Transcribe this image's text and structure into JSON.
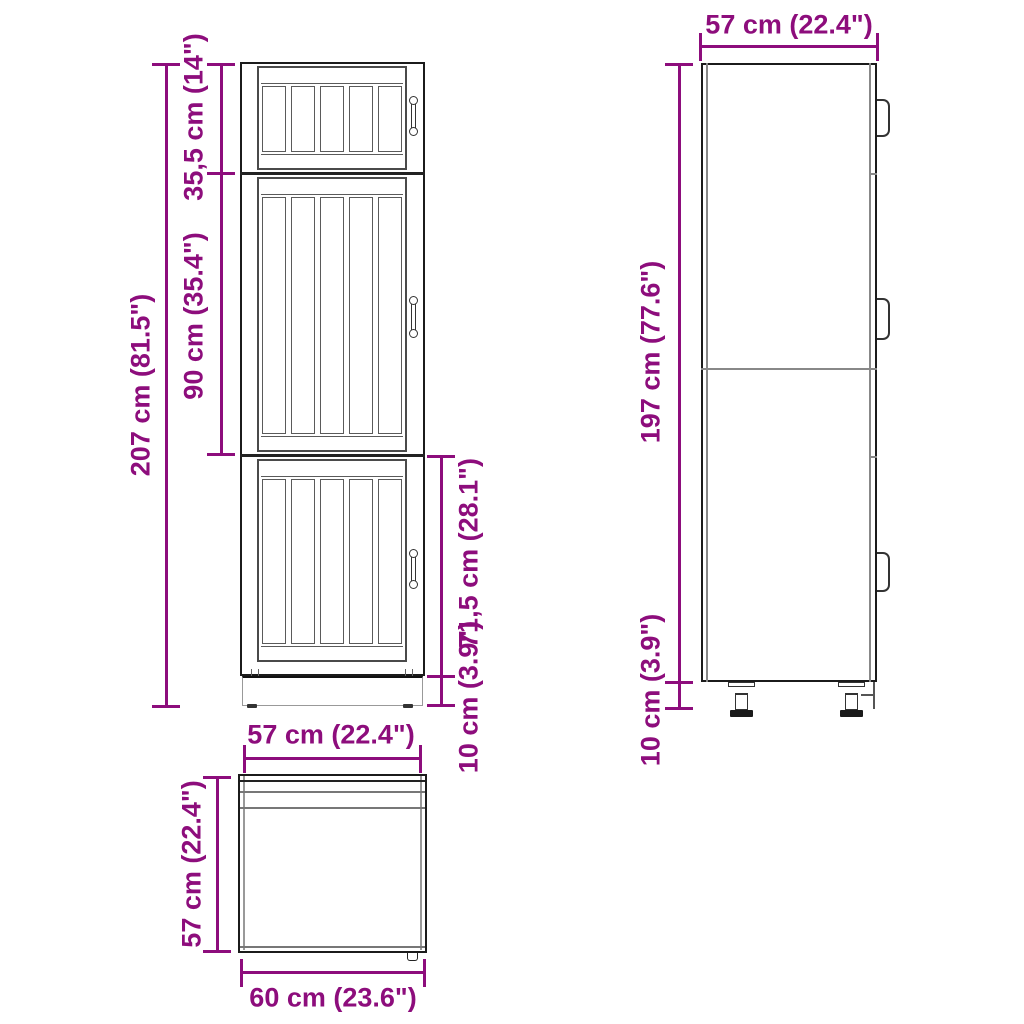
{
  "diagram_title": "tall kitchen cabinet dimension drawing",
  "colors": {
    "accent": "#8d0d7c",
    "line_dark": "#1b1b1b",
    "line_mid": "#555555",
    "line_light": "#999999",
    "background": "#ffffff"
  },
  "views": {
    "front": {
      "dims": {
        "total_height": "207 cm (81.5\")",
        "top_section": "35,5 cm (14\")",
        "middle_section": "90 cm (35.4\")",
        "bottom_section": "71,5 cm (28.1\")",
        "plinth": "10 cm (3.9\")"
      }
    },
    "side": {
      "dims": {
        "depth": "57 cm (22.4\")",
        "body_height": "197 cm (77.6\")",
        "plinth": "10 cm (3.9\")"
      }
    },
    "top": {
      "dims": {
        "depth": "57 cm (22.4\")",
        "side_depth": "57 cm (22.4\")",
        "width": "60 cm (23.6\")"
      }
    }
  }
}
